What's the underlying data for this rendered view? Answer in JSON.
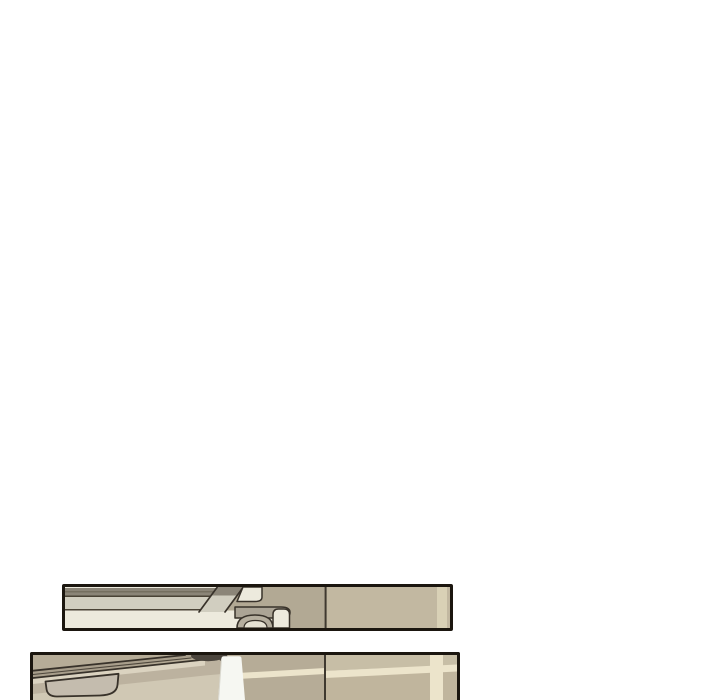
{
  "page": {
    "background": "#ffffff",
    "panel_count": 2
  },
  "panels": [
    {
      "id": "panel-1",
      "position": "upper strip",
      "bottom_edge_visible": true
    },
    {
      "id": "panel-2",
      "position": "lower strip",
      "bottom_edge_visible": false
    }
  ],
  "colors": {
    "page_background": "#ffffff",
    "panel_border": "#1b160f",
    "ink_outline": "#38322a",
    "wall_corner_line": "#3f3930",
    "cream": "#edeadd",
    "band_gray": "#8b8578",
    "band_gray_dark": "#6e6859",
    "band_line": "#4a4336",
    "band_light": "#d1cec0",
    "p1_wall_left": "#b2a994",
    "p1_wall_right": "#c2b8a1",
    "p1_wall_stripe": "#d9d1b6",
    "p1_arm": "#aba495",
    "p1_arch": "#b5ae9e",
    "p1_arch_inner": "#e6e2d3",
    "p2_wall_left": "#b6ac97",
    "p2_wall_right_upper": "#c7bea6",
    "p2_wall_right_lower": "#c0b59d",
    "p2_grout": "#ece4cb",
    "p2_desk_top": "#a89e8b",
    "p2_desk_front": "#bcb29f",
    "p2_desk_highlight": "#dbd3c0",
    "p2_desk_lower": "#d0c8b4",
    "p2_chair": "#c4bcae",
    "p2_dark_object": "#4b453d",
    "p2_white_pillar": "#f6f7f2"
  }
}
